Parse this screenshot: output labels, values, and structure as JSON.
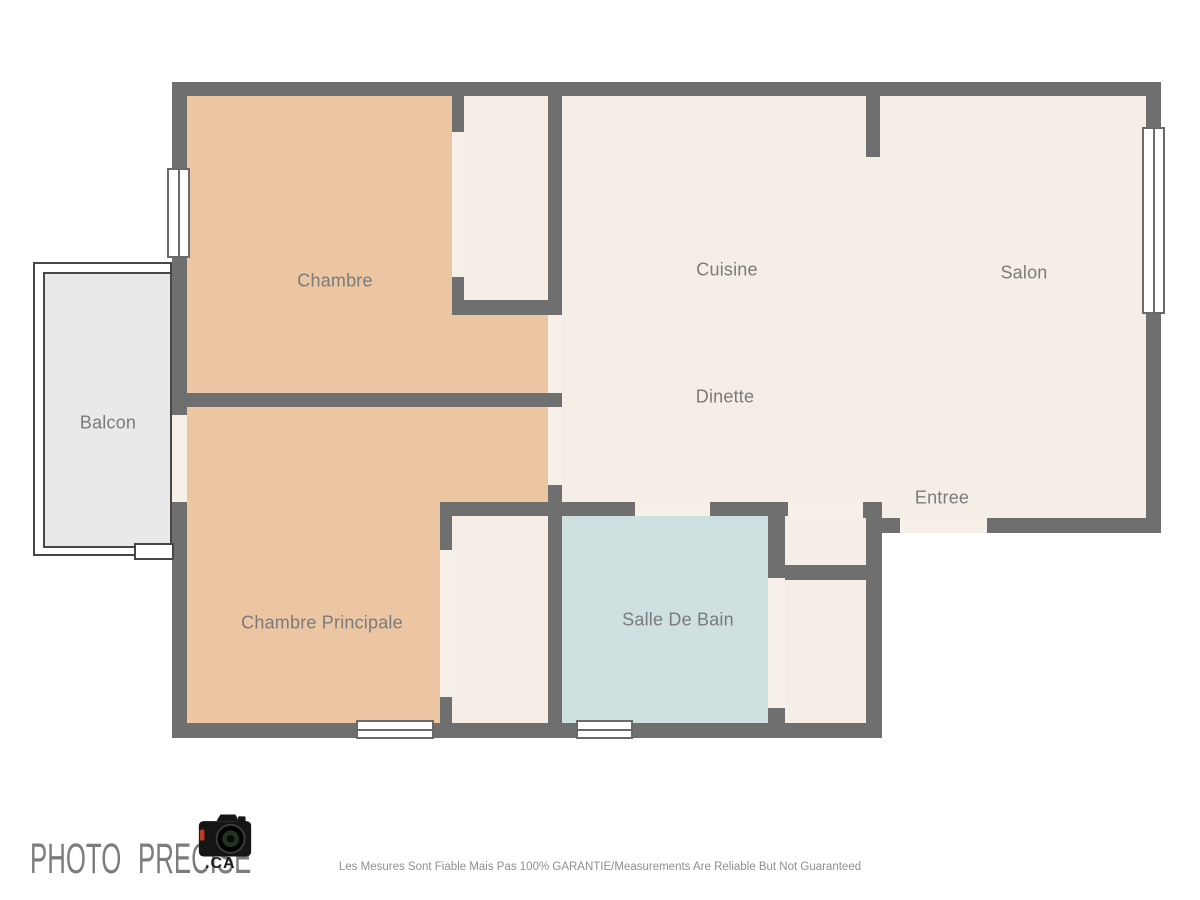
{
  "plan": {
    "rooms": [
      {
        "name": "chambre",
        "label": "Chambre"
      },
      {
        "name": "cuisine",
        "label": "Cuisine"
      },
      {
        "name": "salon",
        "label": "Salon"
      },
      {
        "name": "balcon",
        "label": "Balcon"
      },
      {
        "name": "dinette",
        "label": "Dinette"
      },
      {
        "name": "entree",
        "label": "Entree"
      },
      {
        "name": "chambre-principale",
        "label": "Chambre Principale"
      },
      {
        "name": "salle-de-bain",
        "label": "Salle De Bain"
      }
    ]
  },
  "footer": {
    "brand": "PHOTO PRECISE",
    "brand_suffix": ".CA",
    "disclaimer": "Les Mesures Sont Fiable Mais Pas 100% GARANTIE/Measurements Are Reliable But Not Guaranteed"
  },
  "colors": {
    "wall": "#6f6f6f",
    "bedroom_fill": "#ecc6a3",
    "living_fill": "#f4eee7",
    "bath_fill": "#cfe0e0",
    "balcony_fill": "#e9e9e9",
    "opening_fill": "#f6f0e9",
    "label_text": "#7b7b7b",
    "brand_text": "#7c7c7c",
    "disclaimer_text": "#8f8f8f"
  }
}
